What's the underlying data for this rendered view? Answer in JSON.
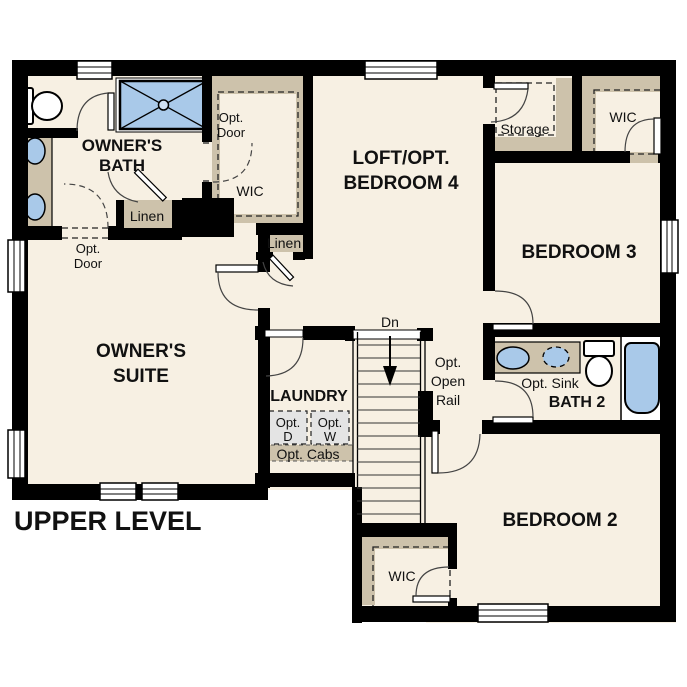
{
  "floor_plan": {
    "title": "UPPER LEVEL",
    "rooms": {
      "owners_suite": {
        "l1": "OWNER'S",
        "l2": "SUITE"
      },
      "owners_bath": {
        "l1": "OWNER'S",
        "l2": "BATH"
      },
      "loft": {
        "l1": "LOFT/OPT.",
        "l2": "BEDROOM 4"
      },
      "bedroom3": {
        "l1": "BEDROOM 3"
      },
      "bedroom2": {
        "l1": "BEDROOM 2"
      },
      "bath2": {
        "l1": "BATH 2"
      },
      "laundry": {
        "l1": "LAUNDRY"
      },
      "storage": {
        "l1": "Storage"
      },
      "owners_wic": {
        "l1": "WIC"
      },
      "bedroom3_wic": {
        "l1": "WIC"
      },
      "bedroom2_wic": {
        "l1": "WIC"
      },
      "linen_bath": {
        "l1": "Linen"
      },
      "linen_hall": {
        "l1": "Linen"
      }
    },
    "annotations": {
      "opt_door_suite": {
        "l1": "Opt.",
        "l2": "Door"
      },
      "opt_door_wic": {
        "l1": "Opt.",
        "l2": "Door"
      },
      "stair_direction": "Dn",
      "opt_open_rail": {
        "l1": "Opt.",
        "l2": "Open",
        "l3": "Rail"
      },
      "opt_sink": "Opt. Sink",
      "opt_dryer": {
        "l1": "Opt.",
        "l2": "D"
      },
      "opt_washer": {
        "l1": "Opt.",
        "l2": "W"
      },
      "opt_cabs": "Opt. Cabs"
    },
    "colors": {
      "wall": "#000000",
      "floor": "#f7f0e3",
      "cabinet": "#cdc2ab",
      "fixture_blue": "#a9c9e9",
      "appliance_gray": "#e4e4e4"
    }
  }
}
